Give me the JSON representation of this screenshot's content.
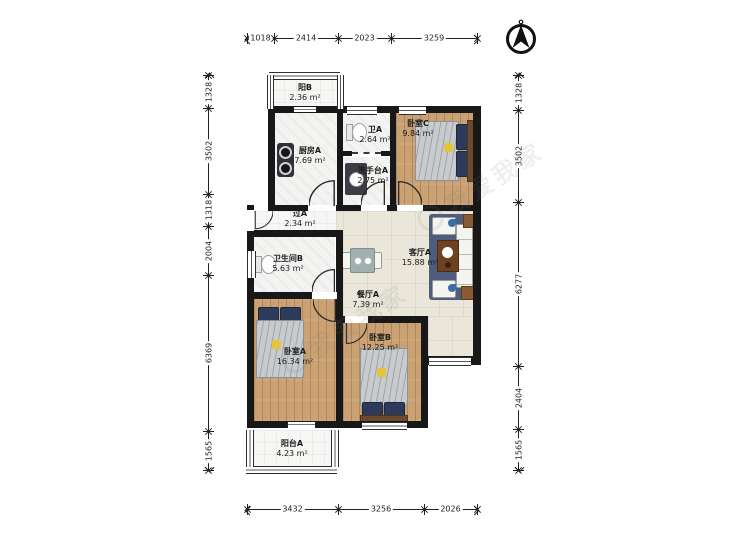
{
  "dimensions": {
    "top": [
      "1018",
      "2414",
      "2023",
      "3259"
    ],
    "bottom": [
      "3432",
      "3256",
      "2026"
    ],
    "left": [
      "1328",
      "3502",
      "1318",
      "2004",
      "6369",
      "1565"
    ],
    "right": [
      "1328",
      "3502",
      "6277",
      "2404",
      "1565"
    ]
  },
  "rooms": [
    {
      "name": "阳B",
      "area": "2.36 m²"
    },
    {
      "name": "厨房A",
      "area": "7.69 m²"
    },
    {
      "name": "卫A",
      "area": "2.64 m²"
    },
    {
      "name": "洗手台A",
      "area": "2.75 m²"
    },
    {
      "name": "卧室C",
      "area": "9.84 m²"
    },
    {
      "name": "过A",
      "area": "2.34 m²"
    },
    {
      "name": "卫生间B",
      "area": "5.63 m²"
    },
    {
      "name": "客厅A",
      "area": "15.88 m²"
    },
    {
      "name": "餐厅A",
      "area": "7.39 m²"
    },
    {
      "name": "卧室A",
      "area": "16.34 m²"
    },
    {
      "name": "卧室B",
      "area": "12.25 m²"
    },
    {
      "name": "阳台A",
      "area": "4.23 m²"
    }
  ],
  "watermark": {
    "text": "我爱我家"
  },
  "compass": {
    "icon": "north-arrow"
  },
  "colors": {
    "wall": "#181818",
    "wood_floor": "#c9a173",
    "tile_floor": "#f3f3f1",
    "living_floor": "#eae6da",
    "pillow_navy": "#2c3a5c",
    "accent_yellow": "#e6c33c",
    "rug_navy": "#4e5d7e",
    "table_brown": "#6e4120"
  }
}
